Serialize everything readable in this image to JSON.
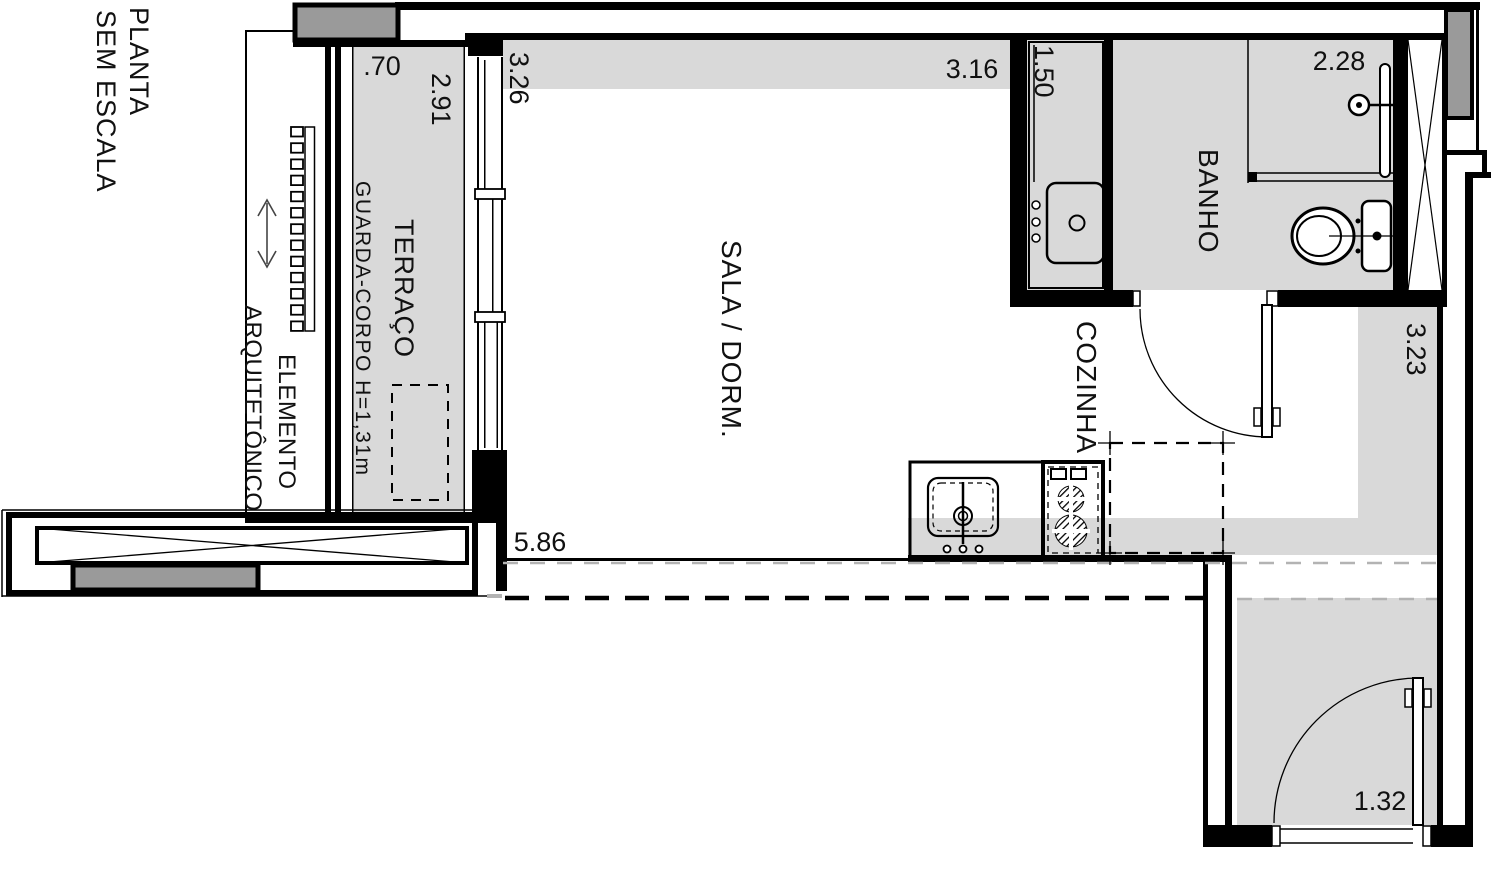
{
  "title": {
    "line1": "PLANTA",
    "line2": "SEM ESCALA"
  },
  "rooms": {
    "terraco": "TERRAÇO",
    "sala": "SALA / DORM.",
    "banho": "BANHO",
    "cozinha": "COZINHA"
  },
  "annotations": {
    "guarda_corpo": "GUARDA-CORPO H=1,31m",
    "elemento_line1": "ELEMENTO",
    "elemento_line2": "ARQUITETÔNICO"
  },
  "dimensions": {
    "terraco_width": ".70",
    "terraco_length": "2.91",
    "sala_depth": "3.26",
    "sala_width": "3.16",
    "bancada_length": "1.50",
    "banho_width": "2.28",
    "hall_length": "3.23",
    "sala_length": "5.86",
    "hall_width": "1.32"
  },
  "colors": {
    "floor_gray": "#d9d9d9",
    "column_gray": "#9a9a9a",
    "line_black": "#000000",
    "dashed_gray": "#b3b3b3"
  }
}
